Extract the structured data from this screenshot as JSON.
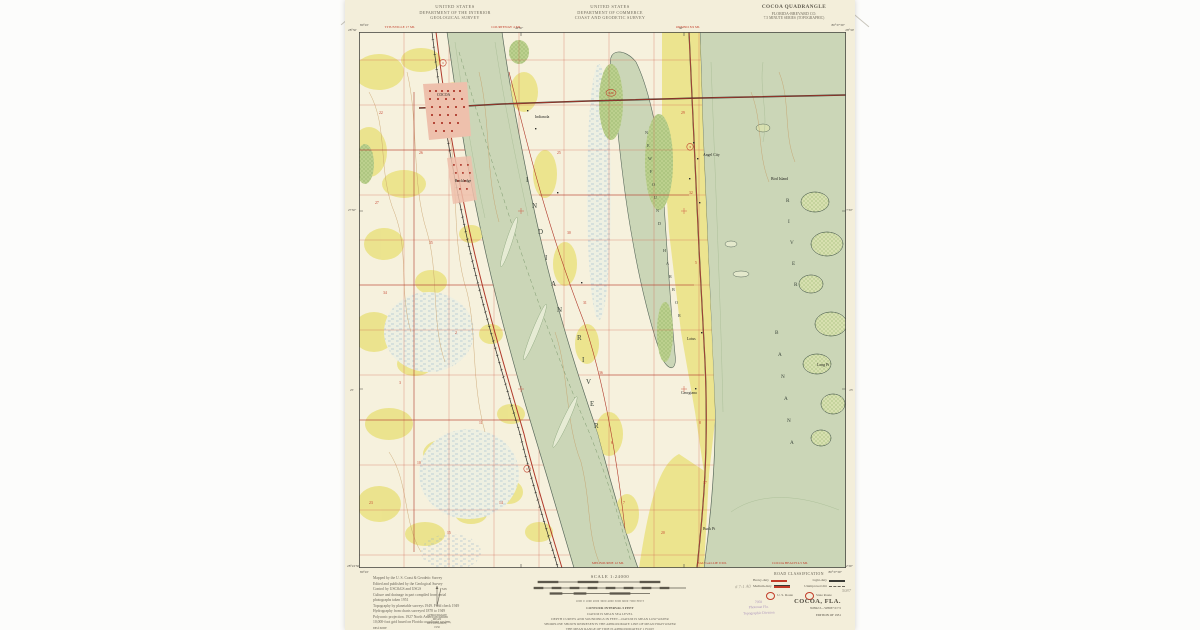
{
  "header": {
    "agency_left": [
      "UNITED STATES",
      "DEPARTMENT OF THE INTERIOR",
      "GEOLOGICAL SURVEY"
    ],
    "agency_center": [
      "UNITED STATES",
      "DEPARTMENT OF COMMERCE",
      "COAST AND GEODETIC SURVEY"
    ],
    "quad": {
      "title": "COCOA QUADRANGLE",
      "subtitle": "FLORIDA-BREVARD CO.",
      "series": "7.5 MINUTE SERIES (TOPOGRAPHIC)"
    }
  },
  "corners": {
    "tl_lon": "80°45'",
    "tl_lat": "28°30'",
    "tr_lon": "80°37'30\"",
    "tr_lat": "28°30'",
    "bl_lat": "28°22'30\"",
    "bl_lon": "80°45'",
    "br_lat": "28°22'30\"",
    "br_lon": "80°37'30\""
  },
  "edge_labels": {
    "top": [
      {
        "t": "TITUSVILLE 17 MI.",
        "x": 400
      },
      {
        "t": "COURTENAY 4 MI.",
        "x": 506
      },
      {
        "t": "ORSINO 8.9 MI.",
        "x": 688
      }
    ],
    "bottom": [
      {
        "t": "MELBOURNE 12 MI.",
        "x": 608
      },
      {
        "t": "EAU GALLIE 9 MI.",
        "x": 712
      },
      {
        "t": "COCOA BEACH 4.5 MI.",
        "x": 790
      }
    ],
    "tick_top_w": "42'30\"",
    "tick_top_e": "40'",
    "tick_left_n": "27'30\"",
    "tick_left_s": "25'",
    "tick_right_n": "27'30\"",
    "tick_right_s": "25'"
  },
  "map_labels": {
    "water_letters": [
      {
        "t": "I",
        "x": 167,
        "y": 150,
        "c": "wl-big"
      },
      {
        "t": "N",
        "x": 173,
        "y": 176,
        "c": "wl-big"
      },
      {
        "t": "D",
        "x": 179,
        "y": 202,
        "c": "wl-big"
      },
      {
        "t": "I",
        "x": 186,
        "y": 228,
        "c": "wl-big"
      },
      {
        "t": "A",
        "x": 192,
        "y": 254,
        "c": "wl-big"
      },
      {
        "t": "N",
        "x": 198,
        "y": 280,
        "c": "wl-big"
      },
      {
        "t": "R",
        "x": 218,
        "y": 308,
        "c": "wl-big"
      },
      {
        "t": "I",
        "x": 223,
        "y": 330,
        "c": "wl-big"
      },
      {
        "t": "V",
        "x": 227,
        "y": 352,
        "c": "wl-big"
      },
      {
        "t": "E",
        "x": 231,
        "y": 374,
        "c": "wl-big"
      },
      {
        "t": "R",
        "x": 235,
        "y": 396,
        "c": "wl-big"
      },
      {
        "t": "N",
        "x": 286,
        "y": 102,
        "c": "wl-sm"
      },
      {
        "t": "E",
        "x": 288,
        "y": 115,
        "c": "wl-sm"
      },
      {
        "t": "W",
        "x": 289,
        "y": 128,
        "c": "wl-sm"
      },
      {
        "t": "F",
        "x": 291,
        "y": 141,
        "c": "wl-sm"
      },
      {
        "t": "O",
        "x": 293,
        "y": 154,
        "c": "wl-sm"
      },
      {
        "t": "U",
        "x": 295,
        "y": 167,
        "c": "wl-sm"
      },
      {
        "t": "N",
        "x": 297,
        "y": 180,
        "c": "wl-sm"
      },
      {
        "t": "D",
        "x": 299,
        "y": 193,
        "c": "wl-sm"
      },
      {
        "t": "H",
        "x": 304,
        "y": 220,
        "c": "wl-sm"
      },
      {
        "t": "A",
        "x": 307,
        "y": 233,
        "c": "wl-sm"
      },
      {
        "t": "R",
        "x": 310,
        "y": 246,
        "c": "wl-sm"
      },
      {
        "t": "B",
        "x": 313,
        "y": 259,
        "c": "wl-sm"
      },
      {
        "t": "O",
        "x": 316,
        "y": 272,
        "c": "wl-sm"
      },
      {
        "t": "R",
        "x": 319,
        "y": 285,
        "c": "wl-sm"
      },
      {
        "t": "B",
        "x": 416,
        "y": 302,
        "c": "wl-mid"
      },
      {
        "t": "A",
        "x": 419,
        "y": 324,
        "c": "wl-mid"
      },
      {
        "t": "N",
        "x": 422,
        "y": 346,
        "c": "wl-mid"
      },
      {
        "t": "A",
        "x": 425,
        "y": 368,
        "c": "wl-mid"
      },
      {
        "t": "N",
        "x": 428,
        "y": 390,
        "c": "wl-mid"
      },
      {
        "t": "A",
        "x": 431,
        "y": 412,
        "c": "wl-mid"
      },
      {
        "t": "R",
        "x": 427,
        "y": 170,
        "c": "wl-mid"
      },
      {
        "t": "I",
        "x": 429,
        "y": 191,
        "c": "wl-mid"
      },
      {
        "t": "V",
        "x": 431,
        "y": 212,
        "c": "wl-mid"
      },
      {
        "t": "E",
        "x": 433,
        "y": 233,
        "c": "wl-mid"
      },
      {
        "t": "R",
        "x": 435,
        "y": 254,
        "c": "wl-mid"
      }
    ],
    "places": [
      {
        "t": "COCOA",
        "x": 78,
        "y": 64,
        "c": "plc"
      },
      {
        "t": "Rockledge",
        "x": 96,
        "y": 150,
        "c": "plc"
      },
      {
        "t": "Indianola",
        "x": 176,
        "y": 86,
        "c": "plc"
      },
      {
        "t": "Angel City",
        "x": 344,
        "y": 124,
        "c": "plc"
      },
      {
        "t": "Lotus",
        "x": 328,
        "y": 308,
        "c": "plc"
      },
      {
        "t": "Georgiana",
        "x": 322,
        "y": 362,
        "c": "plc"
      },
      {
        "t": "Buck Pt",
        "x": 344,
        "y": 498,
        "c": "plc"
      },
      {
        "t": "Bird Island",
        "x": 412,
        "y": 148,
        "c": "plc"
      },
      {
        "t": "Long Pt",
        "x": 458,
        "y": 334,
        "c": "plc"
      }
    ],
    "section_numbers": [
      {
        "t": "22",
        "x": 20,
        "y": 82
      },
      {
        "t": "27",
        "x": 16,
        "y": 172
      },
      {
        "t": "34",
        "x": 24,
        "y": 262
      },
      {
        "t": "3",
        "x": 40,
        "y": 352
      },
      {
        "t": "10",
        "x": 58,
        "y": 432
      },
      {
        "t": "15",
        "x": 88,
        "y": 502
      },
      {
        "t": "26",
        "x": 60,
        "y": 122
      },
      {
        "t": "35",
        "x": 70,
        "y": 212
      },
      {
        "t": "2",
        "x": 96,
        "y": 302
      },
      {
        "t": "11",
        "x": 120,
        "y": 392
      },
      {
        "t": "14",
        "x": 140,
        "y": 472
      },
      {
        "t": "23",
        "x": 10,
        "y": 472
      },
      {
        "t": "25",
        "x": 198,
        "y": 122
      },
      {
        "t": "30",
        "x": 208,
        "y": 202
      },
      {
        "t": "31",
        "x": 224,
        "y": 272
      },
      {
        "t": "36",
        "x": 240,
        "y": 342
      },
      {
        "t": "6",
        "x": 252,
        "y": 412
      },
      {
        "t": "7",
        "x": 264,
        "y": 472
      },
      {
        "t": "29",
        "x": 322,
        "y": 82
      },
      {
        "t": "32",
        "x": 330,
        "y": 162
      },
      {
        "t": "5",
        "x": 336,
        "y": 232
      },
      {
        "t": "8",
        "x": 340,
        "y": 392
      },
      {
        "t": "17",
        "x": 344,
        "y": 452
      },
      {
        "t": "20",
        "x": 302,
        "y": 502
      }
    ],
    "route_shields": [
      {
        "t": "1",
        "x": 84,
        "y": 32
      },
      {
        "t": "1",
        "x": 168,
        "y": 438
      },
      {
        "t": "3",
        "x": 331,
        "y": 116
      },
      {
        "t": "520",
        "x": 252,
        "y": 62
      }
    ]
  },
  "footer": {
    "credits": [
      "Mapped by the U. S. Coast & Geodetic Survey",
      "Edited and published by the Geological Survey",
      "Control by USC&GS and USGS",
      "Culture and drainage in part compiled from aerial",
      "photographs taken 1951",
      "Topography by planetable surveys 1949. Field check 1949",
      "Hydrography from charts surveyed 1878 to 1949",
      "Polyconic projection. 1927 North American datum",
      "10,000-foot grid based on Florida coordinate system,",
      "east zone",
      "Dashed land lines indicate approximate locations",
      "Unchecked elevations are shown in brown"
    ],
    "scale_title": "SCALE 1:24000",
    "mile_ticks": "1          ½          0                              1 MILE",
    "feet_ticks": "1000   0   1000  2000  3000  4000  5000  6000  7000 FEET",
    "km_ticks": "1    .5    0                    1 KILOMETER",
    "notes": [
      "CONTOUR INTERVAL 5 FEET",
      "DATUM IS MEAN SEA LEVEL",
      "DEPTH CURVES AND SOUNDINGS IN FEET—DATUM IS MEAN LOW WATER",
      "SHORELINE SHOWN REPRESENTS THE APPROXIMATE LINE OF MEAN HIGH WATER",
      "THE MEAN RANGE OF TIDE IS APPROXIMATELY 1 FOOT",
      "THIS MAP COMPLIES WITH NATIONAL MAP ACCURACY STANDARDS"
    ],
    "sale_line": "FOR SALE BY U. S. GEOLOGICAL SURVEY, WASHINGTON 25, D. C.",
    "folder_line": "A FOLDER DESCRIBING TOPOGRAPHIC MAPS AND SYMBOLS IS AVAILABLE ON REQUEST",
    "declination": [
      "APPROXIMATE MEAN",
      "DECLINATION, 1950"
    ],
    "roadclass": {
      "title": "ROAD CLASSIFICATION",
      "rows": [
        {
          "label": "Heavy-duty",
          "label2": "Light-duty"
        },
        {
          "label": "Medium-duty",
          "label2": "Unimproved dirt"
        }
      ],
      "us_route": "U. S. Route",
      "state_route": "State Route"
    },
    "title_block": {
      "title": "COCOA, FLA.",
      "coordcode": "N2822.5—W8037.5/7.5",
      "edition": "EDITION OF 1951"
    }
  },
  "stamps": {
    "purple": [
      "7058",
      "Photostat Fla.",
      "Topographic Division"
    ],
    "pencil_a": "# 7-1 A0",
    "pencil_b": "5087"
  },
  "colors": {
    "paper": "#f3eeda",
    "water": "#cbd6b7",
    "land": "#f6f1dd",
    "clearing_yellow": "#ebe38a",
    "vegetation": "#bcd08e",
    "veg_dot": "#6f9a47",
    "marsh": "#8fb0c8",
    "road_red": "#b0392a",
    "grid_red": "#cf5b47",
    "red_text": "#c23b28",
    "contour_brown": "#c49a63",
    "urban": "#eec0ac",
    "stamp_purple": "#8e6fae"
  }
}
